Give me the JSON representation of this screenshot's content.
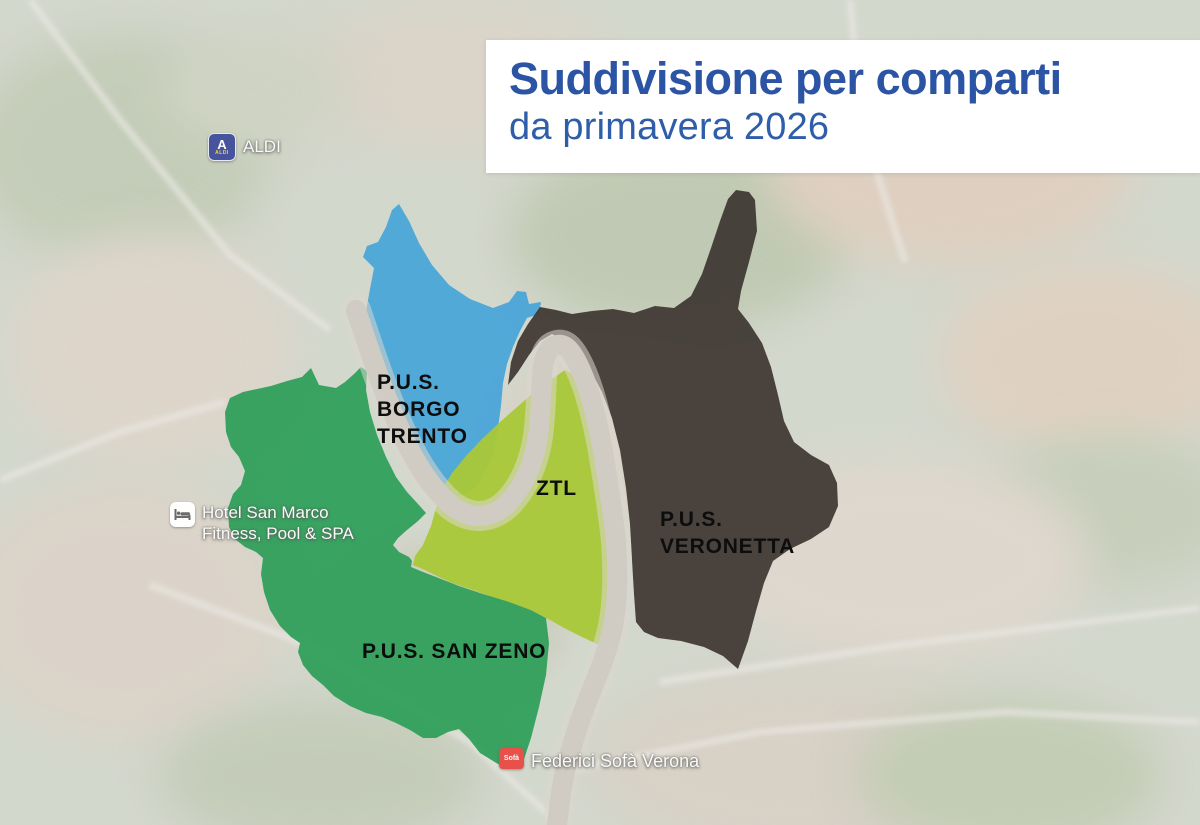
{
  "title_card": {
    "title": "Suddivisione per comparti",
    "subtitle": "da primavera 2026",
    "background": "#ffffff",
    "title_color": "#2b54a4",
    "subtitle_color": "#2e5ea9"
  },
  "zones": [
    {
      "name": "P.U.S. Borgo Trento",
      "lines": [
        "P.U.S.",
        "BORGO",
        "TRENTO"
      ],
      "color": "#47a5d8"
    },
    {
      "name": "ZTL",
      "lines": [
        "ZTL"
      ],
      "color": "#a9c837"
    },
    {
      "name": "P.U.S. Veronetta",
      "lines": [
        "P.U.S.",
        "VERONETTA"
      ],
      "color": "#3d3531"
    },
    {
      "name": "P.U.S. San Zeno",
      "lines": [
        "P.U.S. SAN ZENO"
      ],
      "color": "#2d9e58"
    }
  ],
  "river": {
    "color": "#d0ccc3"
  },
  "pois": [
    {
      "name": "ALDI",
      "icon": "aldi-logo",
      "icon_color": "#46549e",
      "lines": [
        "ALDI"
      ]
    },
    {
      "name": "Hotel San Marco Fitness Pool & SPA",
      "icon": "hotel-bed",
      "lines": [
        "Hotel San Marco",
        "Fitness, Pool & SPA"
      ]
    },
    {
      "name": "Federici Sofà Verona",
      "icon": "sofa-store",
      "icon_color": "#e8504a",
      "icon_text": "Sofà",
      "lines": [
        "Federici Sofà Verona"
      ]
    }
  ]
}
